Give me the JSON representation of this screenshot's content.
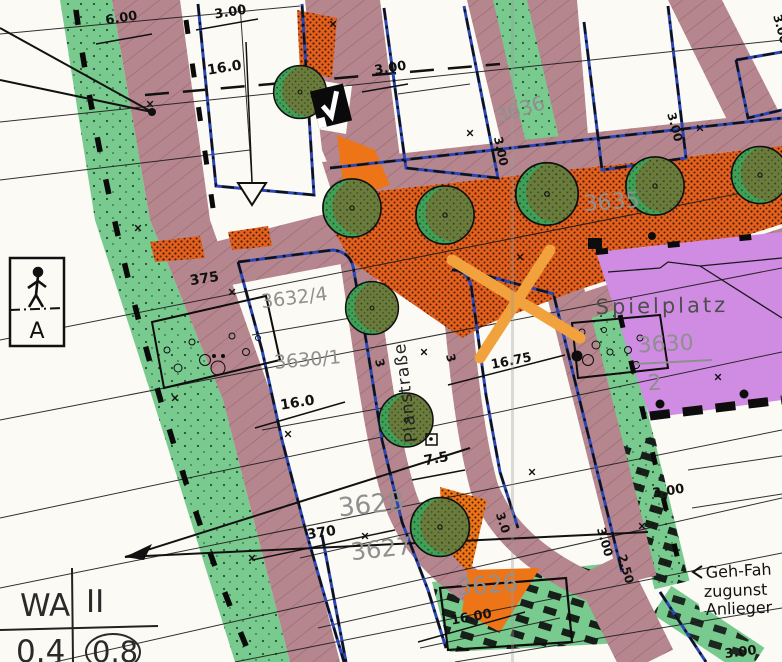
{
  "map_title": "Bebauungsplan-Ausschnitt (zoning plan scan)",
  "parcels": {
    "p3636": "3636",
    "p3635": "3635",
    "p3632_4": "3632/4",
    "p3630_1": "3630/1",
    "p3628": "3628",
    "p3627": "3627",
    "p3626": "3626",
    "p3630_num": "3630",
    "p3630_den": "2"
  },
  "areas": {
    "playground": "Spielplatz"
  },
  "streets": {
    "planstrasse": "Planstraße"
  },
  "dimensions": {
    "d600": "6.00",
    "d300": "3.00",
    "d160": "16.0",
    "d1675": "16.75",
    "d75": "7.5",
    "d375": "375",
    "d370": "370",
    "d1600": "16.00",
    "d30": "3.0",
    "d250": "2.50",
    "d3": "3"
  },
  "zoning_table": {
    "use": "WA",
    "storeys": "II",
    "grz": "0.4",
    "gfz": "0.8"
  },
  "easement_note": {
    "line1": "Geh-Fah",
    "line2": "zugunst",
    "line3": "Anlieger"
  },
  "signs": {
    "pedestrian_letter": "A",
    "checkmark_sign": "V"
  },
  "colors": {
    "street_mauve": "#b5868e",
    "green_strip": "#79ca8e",
    "orange_pavement": "#e55f1d",
    "orange_solid": "#ee7418",
    "playground_purple": "#cf8ce2",
    "marker_orange": "#f2a23c",
    "boundary_blue": "#2a47b8",
    "label_gray": "#8f8f8f"
  }
}
